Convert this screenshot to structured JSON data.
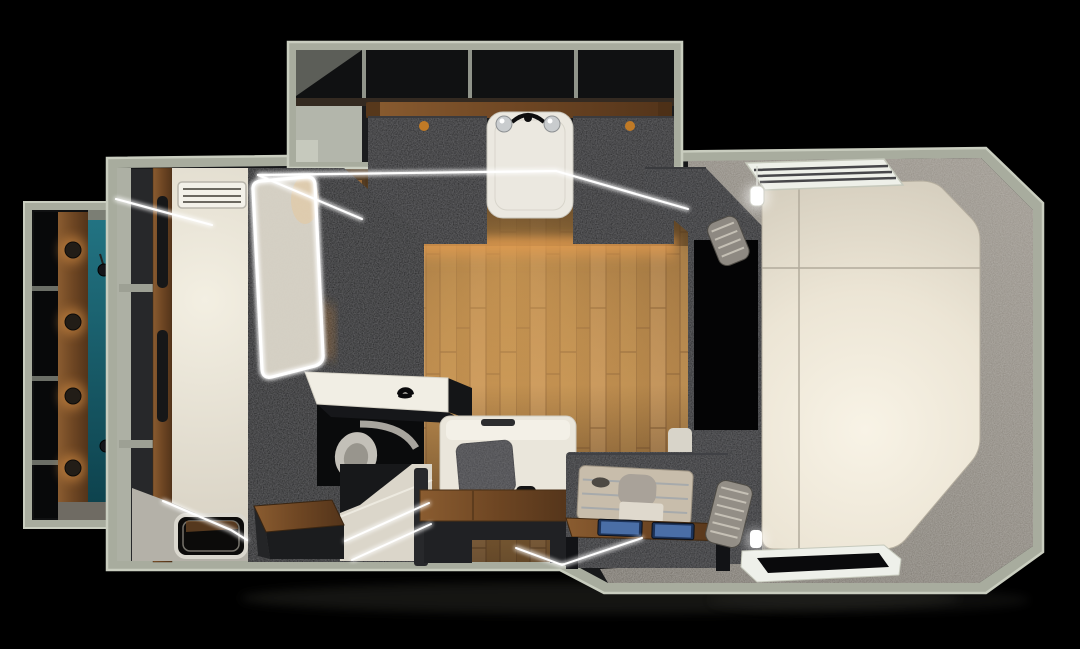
{
  "scene": {
    "type": "3d-floorplan-render",
    "subject": "truck-camper interior, top-down cutaway view",
    "background": "#000000"
  },
  "objects": [
    "overhead-kitchen-unit",
    "kitchen-sink",
    "wardrobe-slideout",
    "teal-entry-floor",
    "entry-door",
    "single-bed",
    "roof-vent",
    "bathroom",
    "led-framed-shower-door",
    "vanity-counter",
    "toilet",
    "shower-tray",
    "wood-stool",
    "floor-hatch",
    "dinette-seat",
    "seat-cushion",
    "wood-bench",
    "galley-drawer",
    "device-screens",
    "step-ottomans",
    "partition-wardrobe",
    "cab-over-mattress",
    "louvered-window",
    "rear-window",
    "hanging-lamp",
    "led-strips",
    "wood-floor",
    "bedroom-carpet"
  ],
  "colors": {
    "wall": "#a8ac9e",
    "wall_edge": "#c9cdbf",
    "interior_dark": "#17181a",
    "cabinet_dark": "#1b1c1e",
    "appliance_dark": "#19191b",
    "doorway_black": "#040405",
    "bathroom_dark": "#0f1011",
    "partition_dark": "#1a1b1e",
    "wood_floor": "#b3884f",
    "wood_trim": "#7a5128",
    "teal_floor": "#1b6474",
    "bed_cream": "#e9e4d6",
    "mattress_white": "#efe9da",
    "carpet_gray": "#8b857c",
    "sink_white": "#ebe8e0",
    "shower_white": "#dbd6ca",
    "vanity_white": "#f1eee4",
    "seat_white": "#eae6db",
    "cushion_gray": "#3c3c40",
    "tray_beige": "#c8bdab",
    "screen_blue": "#4a6ea6",
    "led_white": "#ffffff",
    "amber_glow": "#e89b4a",
    "chrome": "#c9ccce",
    "entry_floor": "#b4b1a8",
    "black_compartment": "#08090a"
  }
}
